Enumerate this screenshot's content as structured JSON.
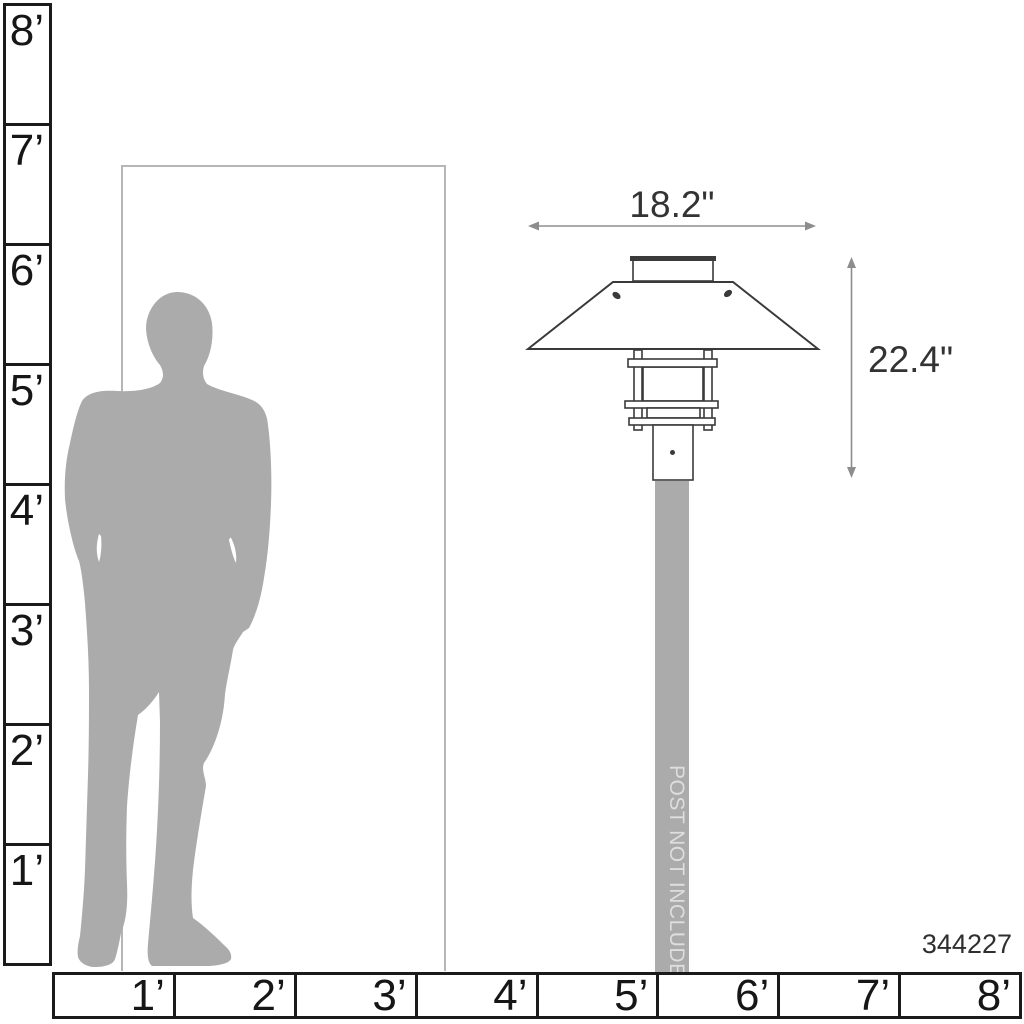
{
  "figure": {
    "width_label": "18.2\"",
    "height_label": "22.4\"",
    "post_note": "POST NOT INCLUDED",
    "product_id": "344227"
  },
  "rulers": {
    "vertical_feet": {
      "labels": [
        "8’",
        "7’",
        "6’",
        "5’",
        "4’",
        "3’",
        "2’",
        "1’"
      ]
    },
    "horizontal_feet": {
      "labels": [
        "1’",
        "2’",
        "3’",
        "4’",
        "5’",
        "6’",
        "7’",
        "8’"
      ]
    }
  },
  "colors": {
    "silhouette": "#ababab",
    "post": "#ababab",
    "post_text": "#dedede",
    "outline": "#3a3a3a",
    "arrow": "#8d8d8d",
    "ruler_line": "#1b1b1b",
    "door_frame": "#b6b6b6",
    "dimension_text": "#333333"
  }
}
